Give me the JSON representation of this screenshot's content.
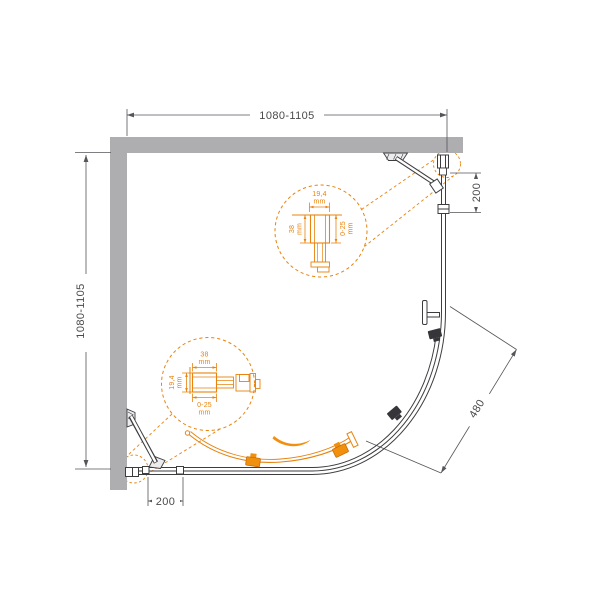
{
  "dimensions": {
    "top": "1080-1105",
    "left": "1080-1105",
    "right": "200",
    "bottom": "200",
    "radius": "480"
  },
  "detail_top": {
    "width": "19,4",
    "width_unit": "mm",
    "depth": "38",
    "depth_unit": "mm",
    "adjustment": "0-25",
    "adjustment_unit": "mm"
  },
  "detail_bottom": {
    "width": "38",
    "width_unit": "mm",
    "depth": "19,4",
    "depth_unit": "mm",
    "adjustment": "0-25",
    "adjustment_unit": "mm"
  },
  "colors": {
    "wall": "#aeaeb0",
    "line": "#3d3d40",
    "dim_text": "#4a4a4c",
    "accent": "#e8830e",
    "accent_fill": "#f18f0e"
  }
}
